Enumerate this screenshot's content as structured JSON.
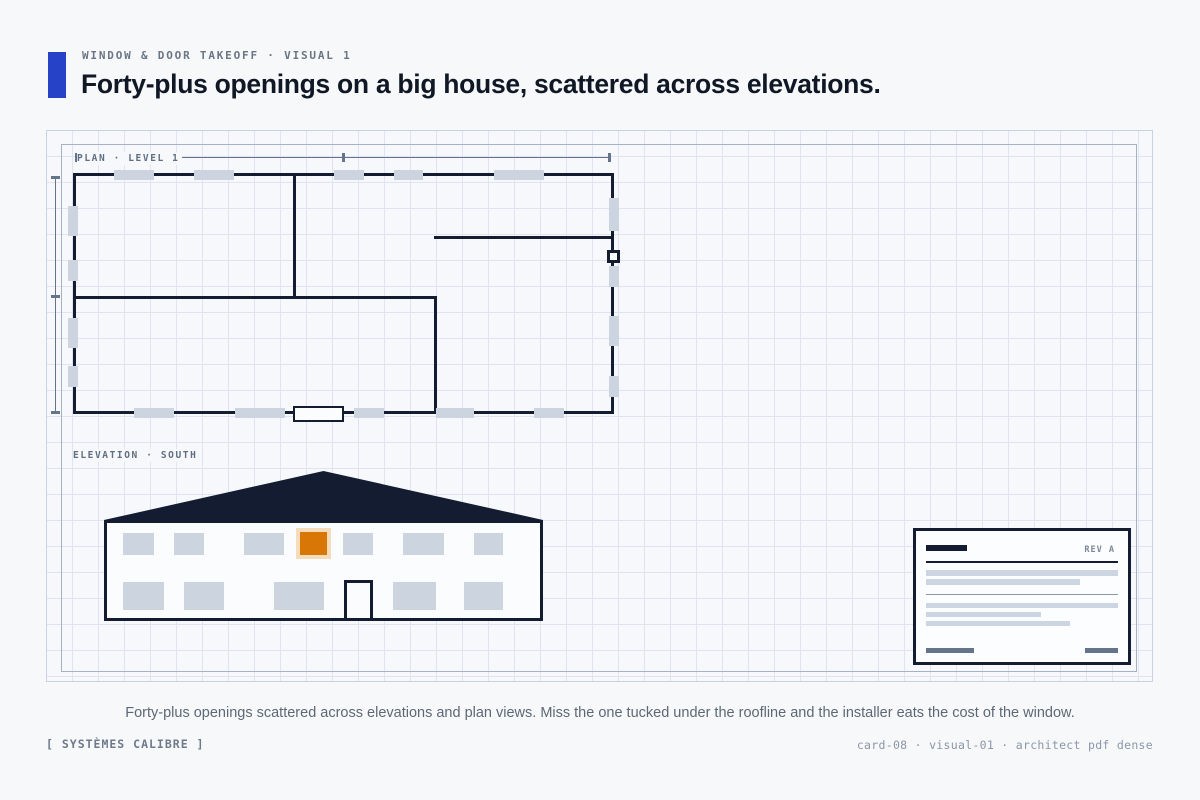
{
  "header": {
    "eyebrow": "WINDOW & DOOR TAKEOFF · VISUAL 1",
    "title": "Forty-plus openings on a big house, scattered across elevations."
  },
  "colors": {
    "accent_blue": "#2643c8",
    "ink_navy": "#131c30",
    "marker_gray": "#ccd4df",
    "highlight_orange": "#d97706",
    "highlight_halo": "#f5dcba",
    "dim_slate": "#64748b"
  },
  "figure": {
    "plan": {
      "label": "PLAN · LEVEL 1",
      "outline": [
        26,
        42,
        541,
        241
      ],
      "interior_walls": [
        [
          246,
          42,
          3,
          126
        ],
        [
          26,
          165,
          364,
          3
        ],
        [
          387,
          165,
          3,
          118
        ],
        [
          387,
          105,
          180,
          3
        ]
      ],
      "window_markers": [
        [
          67,
          39,
          40,
          10
        ],
        [
          147,
          39,
          40,
          10
        ],
        [
          287,
          39,
          30,
          10
        ],
        [
          347,
          39,
          29,
          10
        ],
        [
          447,
          39,
          50,
          10
        ],
        [
          87,
          277,
          40,
          10
        ],
        [
          188,
          277,
          50,
          10
        ],
        [
          307,
          277,
          30,
          10
        ],
        [
          389,
          277,
          38,
          10
        ],
        [
          487,
          277,
          30,
          10
        ],
        [
          21,
          75,
          10,
          30
        ],
        [
          21,
          129,
          10,
          21
        ],
        [
          21,
          187,
          10,
          30
        ],
        [
          21,
          235,
          10,
          21
        ],
        [
          562,
          67,
          10,
          33
        ],
        [
          562,
          135,
          10,
          21
        ],
        [
          562,
          185,
          10,
          30
        ],
        [
          562,
          245,
          10,
          21
        ]
      ],
      "door": [
        246,
        275,
        51,
        16
      ],
      "missed_opening": [
        560,
        119,
        13,
        13
      ],
      "dim_line_top": [
        29,
        26,
        533,
        1
      ],
      "dim_line_left": [
        8,
        46,
        1,
        237
      ],
      "dim_ticks_top": [
        [
          28,
          22,
          3,
          9
        ],
        [
          295,
          22,
          3,
          9
        ],
        [
          561,
          22,
          3,
          9
        ]
      ],
      "dim_ticks_left": [
        [
          4,
          45,
          9,
          3
        ],
        [
          4,
          164,
          9,
          3
        ],
        [
          4,
          280,
          9,
          3
        ]
      ]
    },
    "elevation": {
      "label": "ELEVATION · SOUTH",
      "roof": [
        57,
        340,
        439,
        49
      ],
      "facade": [
        57,
        389,
        439,
        101
      ],
      "windows": [
        [
          76,
          402,
          31,
          22
        ],
        [
          127,
          402,
          30,
          22
        ],
        [
          197,
          402,
          40,
          22
        ],
        [
          296,
          402,
          30,
          22
        ],
        [
          356,
          402,
          41,
          22
        ],
        [
          427,
          402,
          29,
          22
        ],
        [
          76,
          451,
          41,
          28
        ],
        [
          137,
          451,
          40,
          28
        ],
        [
          227,
          451,
          50,
          28
        ],
        [
          346,
          451,
          43,
          28
        ],
        [
          417,
          451,
          39,
          28
        ]
      ],
      "highlight_window": [
        249,
        397,
        35,
        31
      ],
      "door": [
        297,
        449,
        29,
        41
      ]
    },
    "titleblock": {
      "rev": "REV A",
      "logo_bar": [
        13,
        17,
        41,
        6
      ],
      "dark_rule": [
        13,
        33,
        192,
        2
      ],
      "text_bars_upper": [
        [
          13,
          42,
          192,
          6
        ],
        [
          13,
          51,
          154,
          6
        ]
      ],
      "light_rule": [
        13,
        66,
        192,
        1
      ],
      "text_bars_lower": [
        [
          13,
          75,
          192,
          5
        ],
        [
          13,
          84,
          115,
          5
        ],
        [
          13,
          93,
          144,
          5
        ]
      ],
      "signature_bars": [
        [
          13,
          120,
          48,
          5
        ],
        [
          172,
          120,
          33,
          5
        ]
      ]
    }
  },
  "caption": "Forty-plus openings scattered across elevations and plan views. Miss the one tucked under the roofline and the installer eats the cost of the window.",
  "footer": {
    "left": "[ SYSTÈMES CALIBRE ]",
    "right": "card-08 · visual-01 · architect pdf dense"
  }
}
